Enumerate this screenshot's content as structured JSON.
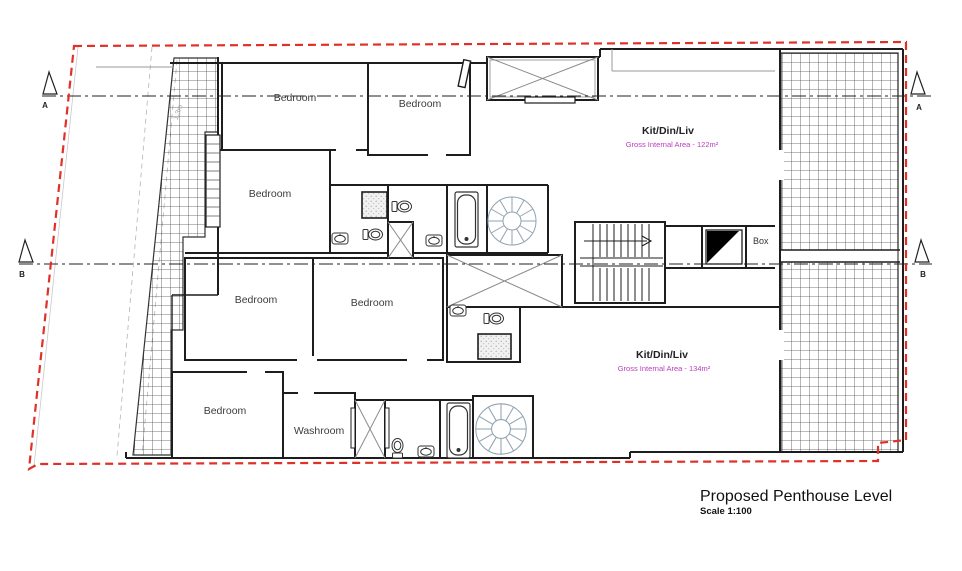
{
  "drawing": {
    "title": "Proposed Penthouse Level",
    "scale": "Scale 1:100"
  },
  "labels": {
    "bedroom": "Bedroom",
    "washroom": "Washroom",
    "kit_din_liv": "Kit/Din/Liv",
    "apt1_area": "Gross Internal Area - 122m²",
    "apt2_area": "Gross Internal Area - 134m²",
    "box": "Box",
    "section_a": "A",
    "section_b": "B",
    "dim": "1.3m"
  },
  "colors": {
    "boundary_red": "#e03128",
    "area_magenta": "#bb3cbb",
    "wall": "#1d1d1d"
  }
}
